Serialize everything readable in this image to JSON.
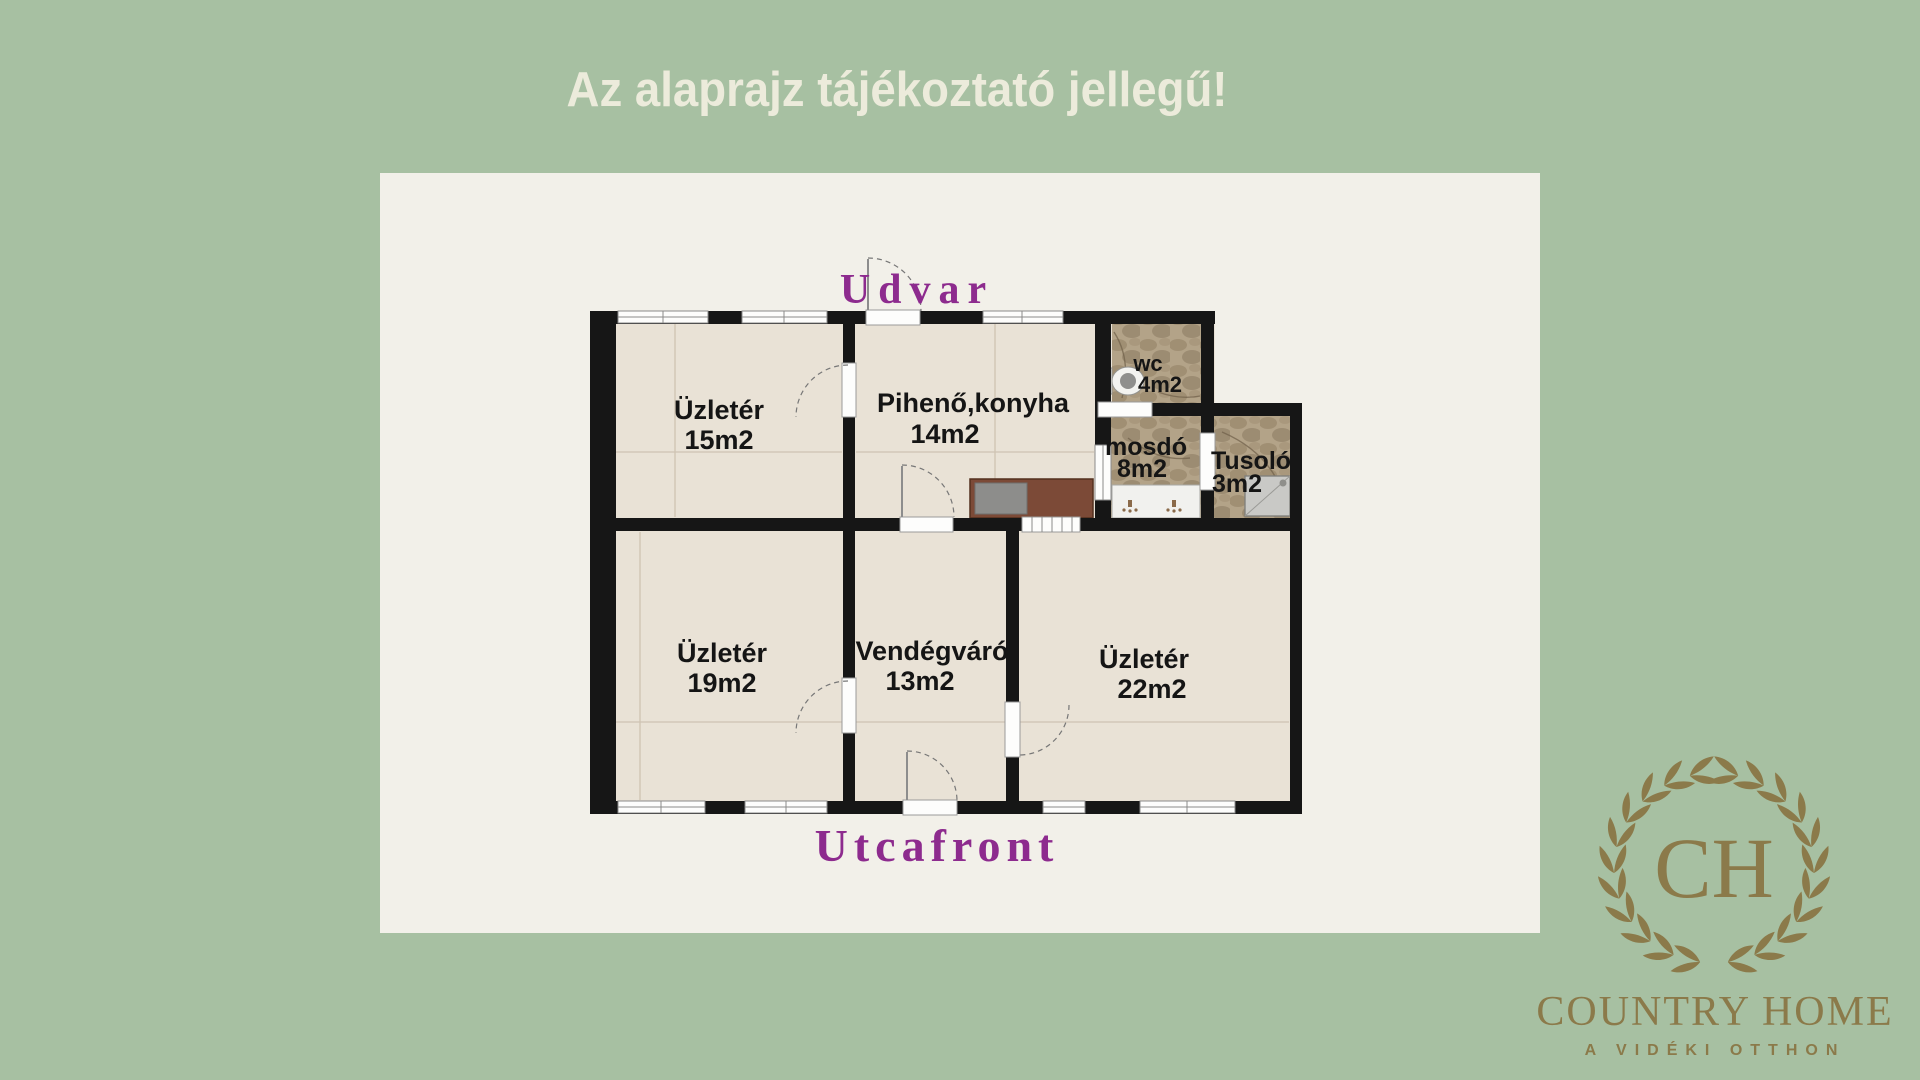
{
  "title": "Az alaprajz tájékoztató jellegű!",
  "plan": {
    "top_label": "Udvar",
    "bottom_label": "Utcafront",
    "rooms": [
      {
        "name": "Üzletér",
        "area": "15m2"
      },
      {
        "name": "Pihenő,konyha",
        "area": "14m2"
      },
      {
        "name": "wc",
        "area": "4m2"
      },
      {
        "name": "mosdó",
        "area": "8m2"
      },
      {
        "name": "Tusoló",
        "area": "3m2"
      },
      {
        "name": "Üzletér",
        "area": "19m2"
      },
      {
        "name": "Vendégváró",
        "area": "13m2"
      },
      {
        "name": "Üzletér",
        "area": "22m2"
      }
    ]
  },
  "logo": {
    "monogram": "CH",
    "name": "COUNTRY HOME",
    "tagline": "A VIDÉKI OTTHON"
  },
  "colors": {
    "background_green": "#a7c0a2",
    "panel_cream": "#f2f0e9",
    "title_cream": "#ecebdb",
    "floor_cream": "#e9e2d6",
    "bathroom_tan": "#b3a388",
    "wall_black": "#161616",
    "label_purple": "#8d2b8e",
    "logo_bronze": "#8b7a4a",
    "counter_brown": "#7c4a37",
    "counter_grey": "#8d8d8b"
  }
}
